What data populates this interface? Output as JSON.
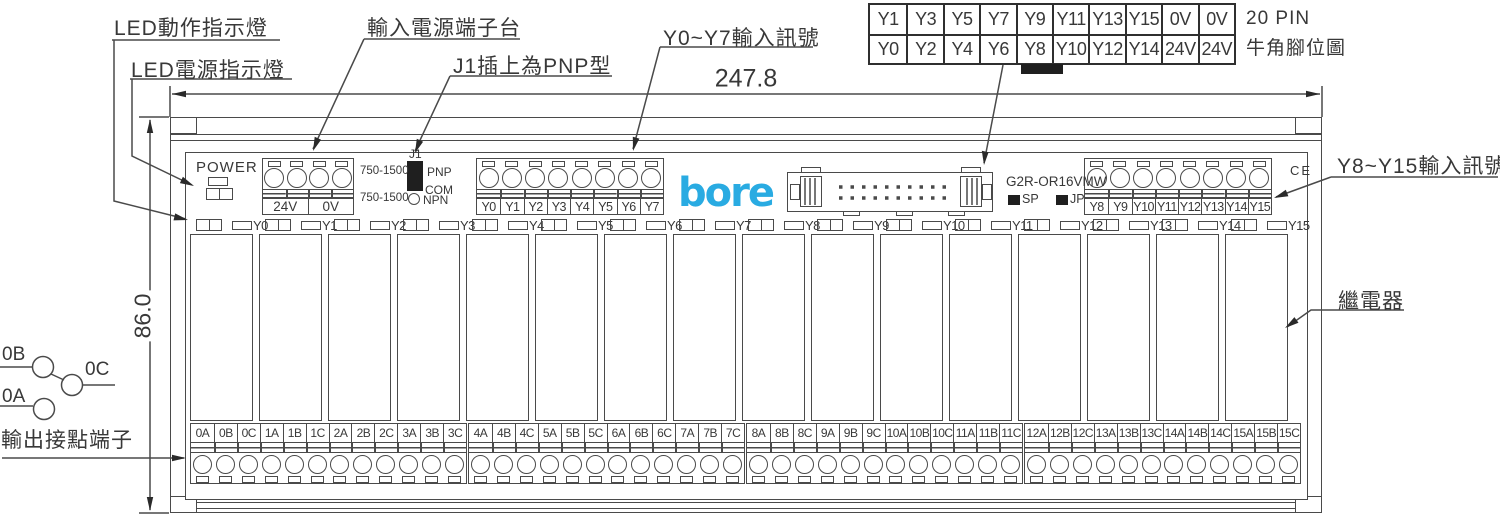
{
  "colors": {
    "line": "#4a4a4a",
    "text": "#383838",
    "logo_blue": "#29abe2",
    "black": "#1f1f1f"
  },
  "callouts": {
    "led_action": "LED動作指示燈",
    "led_power": "LED電源指示燈",
    "input_power_terminal": "輸入電源端子台",
    "j1_pnp": "J1插上為PNP型",
    "y0_y7_input": "Y0~Y7輸入訊號",
    "y8_y15_input": "Y8~Y15輸入訊號",
    "relay": "繼電器",
    "output_contact_terminal": "輸出接點端子"
  },
  "dimensions": {
    "width_mm": "247.8",
    "height_mm": "86.0"
  },
  "pin_header": {
    "caption_line1": "20 PIN",
    "caption_line2": "牛角腳位圖",
    "rows": [
      [
        "Y1",
        "Y3",
        "Y5",
        "Y7",
        "Y9",
        "Y11",
        "Y13",
        "Y15",
        "0V",
        "0V"
      ],
      [
        "Y0",
        "Y2",
        "Y4",
        "Y6",
        "Y8",
        "Y10",
        "Y12",
        "Y14",
        "24V",
        "24V"
      ]
    ]
  },
  "board": {
    "power_label": "POWER",
    "logo": "bore",
    "model": "G2R-OR16VMW",
    "sp_label": "SP",
    "jp_label": "JP",
    "ce_mark": "CE",
    "j1": {
      "label": "J1",
      "range_top": "750-1500",
      "range_bottom": "750-1500",
      "pnp": "PNP",
      "com": "COM",
      "npn": "NPN"
    },
    "power_block": [
      "24V",
      "0V"
    ],
    "y_low_block": [
      "Y0",
      "Y1",
      "Y2",
      "Y3",
      "Y4",
      "Y5",
      "Y6",
      "Y7"
    ],
    "y_high_block": [
      "Y8",
      "Y9",
      "Y10",
      "Y11",
      "Y12",
      "Y13",
      "Y14",
      "Y15"
    ],
    "led_row": [
      "Y0",
      "Y1",
      "Y2",
      "Y3",
      "Y4",
      "Y5",
      "Y6",
      "Y7",
      "Y8",
      "Y9",
      "Y10",
      "Y11",
      "Y12",
      "Y13",
      "Y14",
      "Y15"
    ],
    "output_groups": [
      [
        "0A",
        "0B",
        "0C",
        "1A",
        "1B",
        "1C",
        "2A",
        "2B",
        "2C",
        "3A",
        "3B",
        "3C"
      ],
      [
        "4A",
        "4B",
        "4C",
        "5A",
        "5B",
        "5C",
        "6A",
        "6B",
        "6C",
        "7A",
        "7B",
        "7C"
      ],
      [
        "8A",
        "8B",
        "8C",
        "9A",
        "9B",
        "9C",
        "10A",
        "10B",
        "10C",
        "11A",
        "11B",
        "11C"
      ],
      [
        "12A",
        "12B",
        "12C",
        "13A",
        "13B",
        "13C",
        "14A",
        "14B",
        "14C",
        "15A",
        "15B",
        "15C"
      ]
    ]
  },
  "contact_symbol": {
    "nc": "0B",
    "common": "0C",
    "no": "0A"
  }
}
